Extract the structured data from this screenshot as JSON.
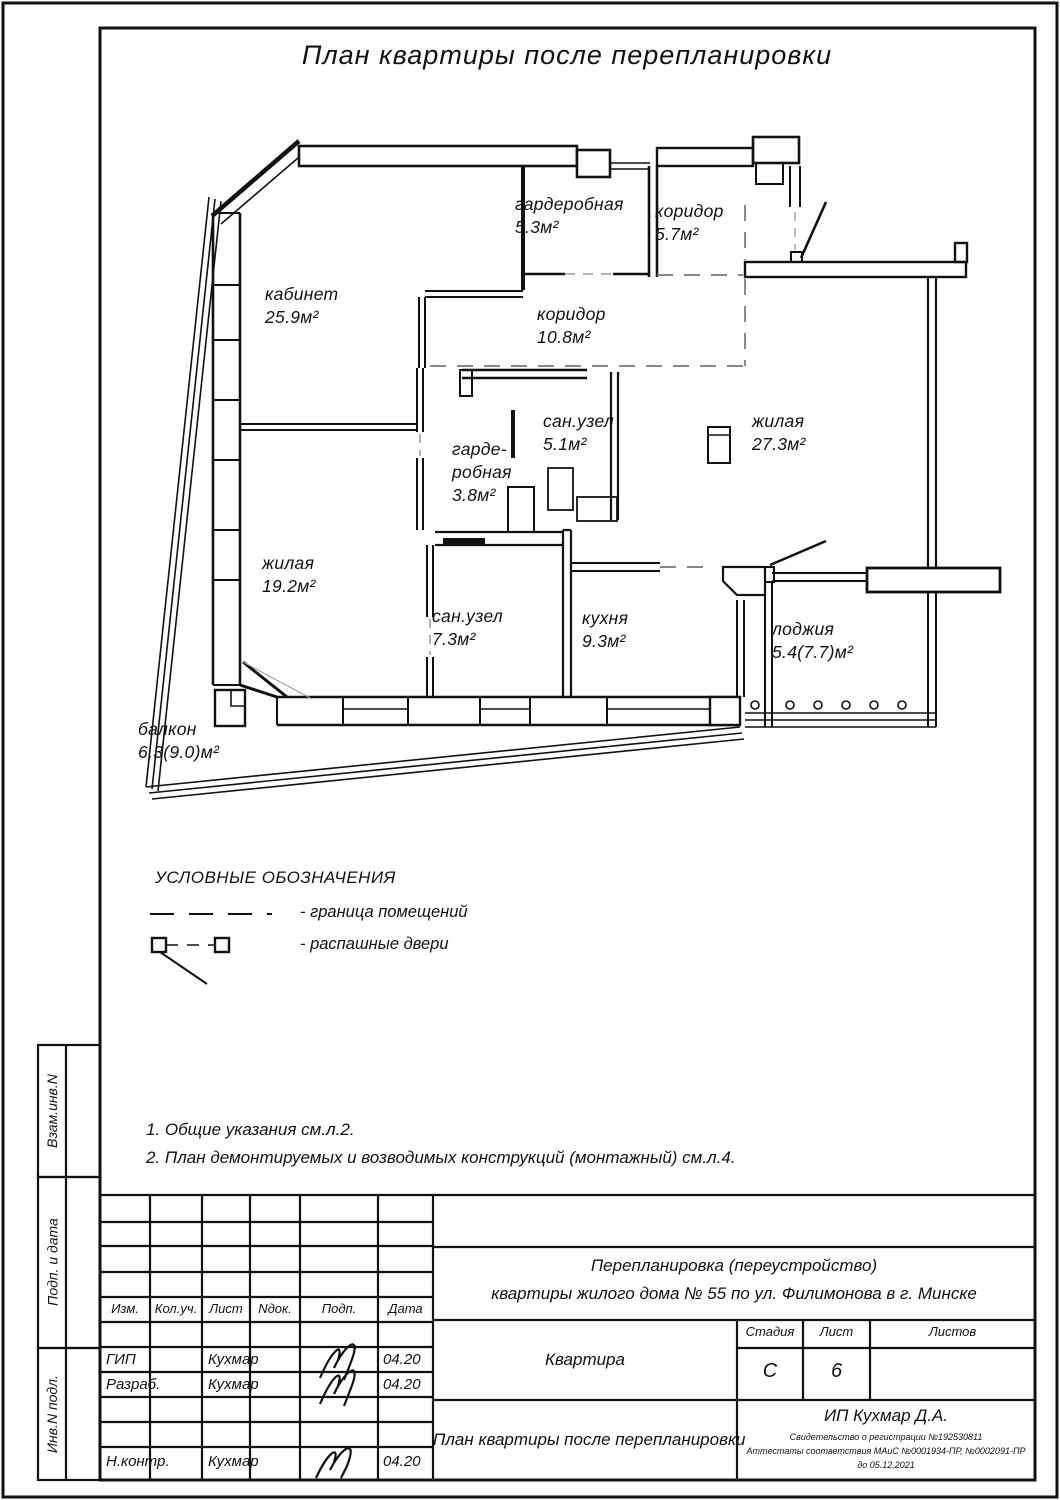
{
  "page": {
    "title": "План квартиры после перепланировки"
  },
  "plan": {
    "rooms": [
      {
        "name": "гардеробная",
        "area": "5.3м²"
      },
      {
        "name": "коридор",
        "area": "5.7м²"
      },
      {
        "name": "кабинет",
        "area": "25.9м²"
      },
      {
        "name": "коридор",
        "area": "10.8м²"
      },
      {
        "name": "сан.узел",
        "area": "5.1м²"
      },
      {
        "name": "гарде-",
        "name2": "робная",
        "area": "3.8м²"
      },
      {
        "name": "жилая",
        "area": "27.3м²"
      },
      {
        "name": "жилая",
        "area": "19.2м²"
      },
      {
        "name": "сан.узел",
        "area": "7.3м²"
      },
      {
        "name": "кухня",
        "area": "9.3м²"
      },
      {
        "name": "лоджия",
        "area": "5.4(7.7)м²"
      },
      {
        "name": "балкон",
        "area": "6.3(9.0)м²"
      }
    ]
  },
  "legend": {
    "title": "УСЛОВНЫЕ ОБОЗНАЧЕНИЯ",
    "items": [
      {
        "symbol": "dashed-line",
        "label": "-  граница помещений"
      },
      {
        "symbol": "swing-doors",
        "label": "-  распашные двери"
      }
    ]
  },
  "notes": {
    "line1": "1.  Общие указания см.л.2.",
    "line2": "2.  План демонтируемых и возводимых конструкций (монтажный) см.л.4."
  },
  "stamp": {
    "left_header": [
      "Изм.",
      "Кол.уч.",
      "Лист",
      "Nдок.",
      "Подп.",
      "Дата"
    ],
    "rows": [
      {
        "role": "ГИП",
        "name": "Кухмар",
        "date": "04.20"
      },
      {
        "role": "Разраб.",
        "name": "Кухмар",
        "date": "04.20"
      },
      {
        "role": "Н.контр.",
        "name": "Кухмар",
        "date": "04.20"
      }
    ],
    "project_line1": "Перепланировка (переустройство)",
    "project_line2": "квартиры жилого дома № 55 по ул. Филимонова в г. Минске",
    "object_name": "Квартира",
    "sheet_title": "План квартиры после перепланировки",
    "stage_label": "Стадия",
    "sheet_label": "Лист",
    "sheets_label": "Листов",
    "stage": "С",
    "sheet": "6",
    "sheets": "",
    "company": "ИП Кухмар Д.А.",
    "cert1": "Свидетельство о регистрации №192530811",
    "cert2": "Аттестаты соответствия МАиС №0001934-ПР, №0002091-ПР",
    "cert3": "до 05.12.2021",
    "side_labels": [
      "Взам.инв.N",
      "Подп. и дата",
      "Инв.N подл."
    ]
  }
}
